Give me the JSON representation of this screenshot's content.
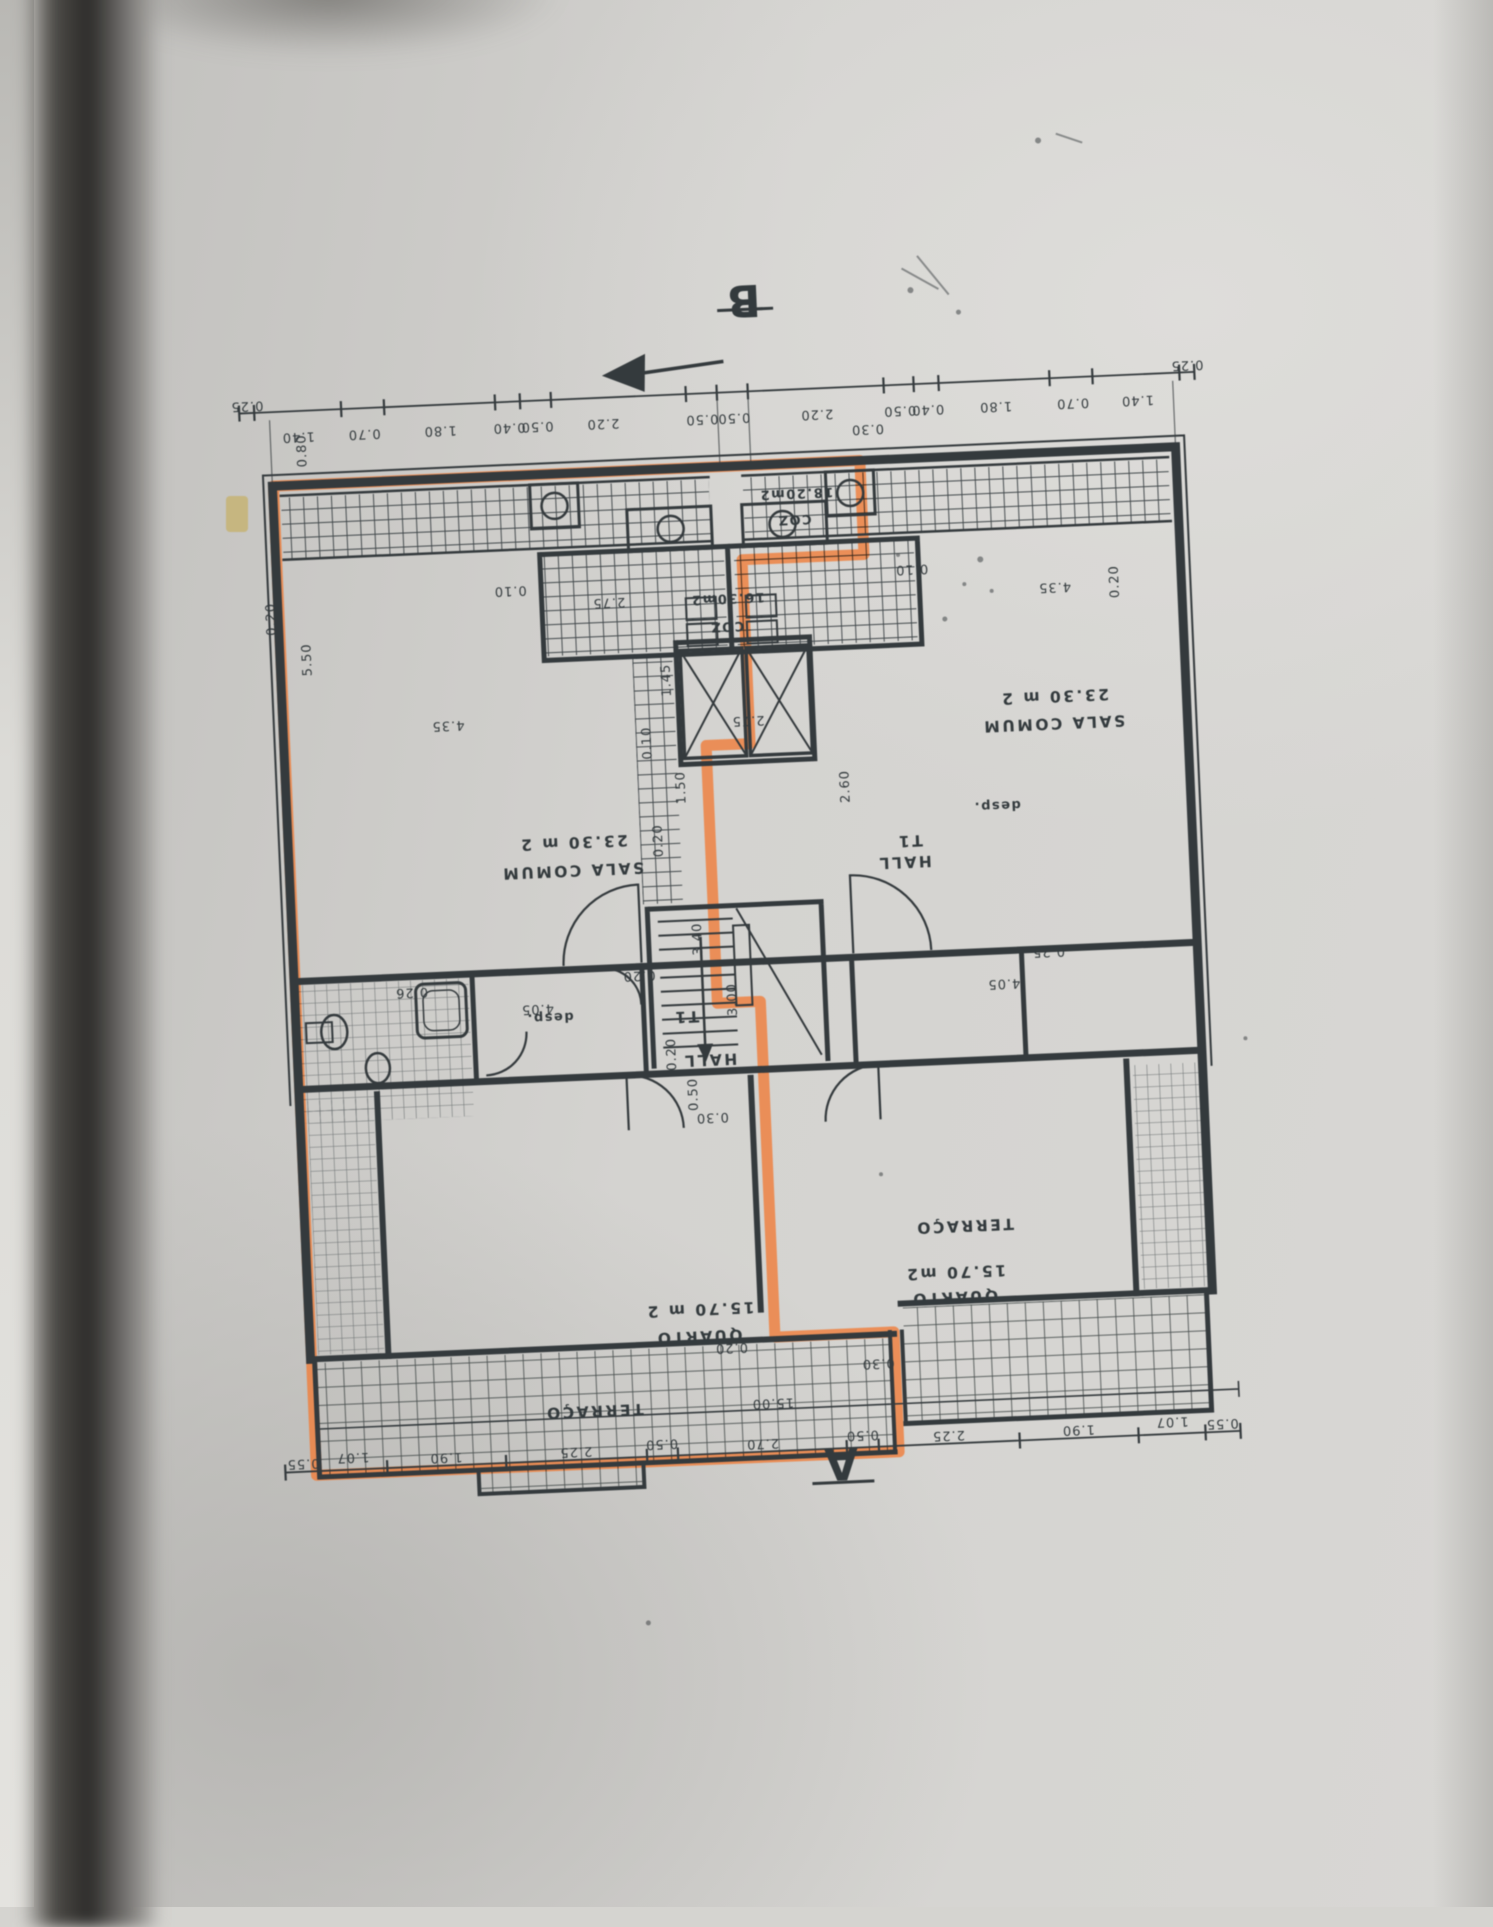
{
  "plan": {
    "markers": {
      "a": "A",
      "b": "B"
    },
    "chains": {
      "top": [
        "0.25",
        "1.40",
        "0.70",
        "1.80",
        "0.40",
        "0.50",
        "2.20",
        "0.50",
        "0.50",
        "2.20",
        "0.50",
        "0.40",
        "1.80",
        "0.70",
        "1.40",
        "0.25"
      ],
      "bottom": [
        "0.55",
        "1.07",
        "1.90",
        "2.25",
        "0.50",
        "2.70",
        "0.50",
        "2.25",
        "1.90",
        "1.07",
        "0.55"
      ],
      "total": "15.00"
    },
    "dims": [
      "0.80",
      "0.20",
      "5.50",
      "0.10",
      "4.35",
      "2.75",
      "2.75",
      "1.45",
      "0.10",
      "1.50",
      "2.60",
      "0.20",
      "3.40",
      "3.00",
      "0.20",
      "0.26",
      "4.05",
      "0.20",
      "0.50",
      "0.30",
      "4.05",
      "0.25",
      "0.10",
      "4.35",
      "0.20",
      "0.20",
      "0.30",
      "0.30"
    ],
    "rooms": {
      "left": {
        "sala": "SALA COMUM",
        "sala_area": "23.30 m 2",
        "coz": "COZ",
        "coz_area": "16.30m2",
        "desp": "desp.",
        "type": "T1",
        "hall": "HALL",
        "quarto": "QUARTO",
        "quarto_area": "15.70 m 2",
        "terraco": "TERRAÇO"
      },
      "right": {
        "sala": "SALA COMUM",
        "sala_area": "23.30 m 2",
        "coz": "COZ",
        "coz_area": "18.20m2",
        "desp": "desp.",
        "type": "T1",
        "hall": "HALL",
        "quarto": "QUARTO",
        "quarto_area": "15.70 m2",
        "terraco": "TERRAÇO"
      }
    }
  }
}
